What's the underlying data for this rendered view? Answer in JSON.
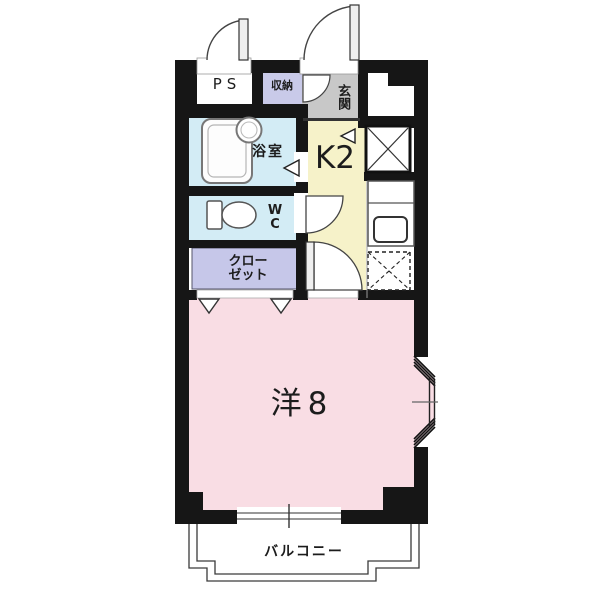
{
  "floorplan": {
    "type": "apartment-1K-floorplan",
    "rooms": {
      "ps": {
        "label": "PS"
      },
      "storage": {
        "label": "収納"
      },
      "entrance": {
        "label": "玄関"
      },
      "bathroom": {
        "label": "浴室"
      },
      "kitchen": {
        "label": "K2"
      },
      "toilet": {
        "line1": "W",
        "line2": "C"
      },
      "closet": {
        "line1": "クロー",
        "line2": "ゼット"
      },
      "western_room": {
        "label": "洋8"
      },
      "balcony": {
        "label": "バルコニー"
      }
    },
    "colors": {
      "wall": "#161616",
      "storage_fill": "#c9cae9",
      "closet_fill": "#c6c7e9",
      "entrance_fill": "#c8c8c8",
      "bathroom_fill": "#d3ecf5",
      "toilet_fill": "#d3ecf5",
      "kitchen_fill": "#f6f2c9",
      "western_room_fill": "#f9dde4",
      "balcony_line": "#3a3a3a"
    },
    "icons": [
      "door-swing-icon",
      "bathtub-icon",
      "washbasin-icon",
      "toilet-icon",
      "kitchen-sink-icon",
      "shaft-x-icon",
      "appliance-space-x-icon",
      "bay-window-icon",
      "folding-door-icon",
      "step-marker-icon",
      "window-icon",
      "balcony-outline-icon"
    ]
  }
}
